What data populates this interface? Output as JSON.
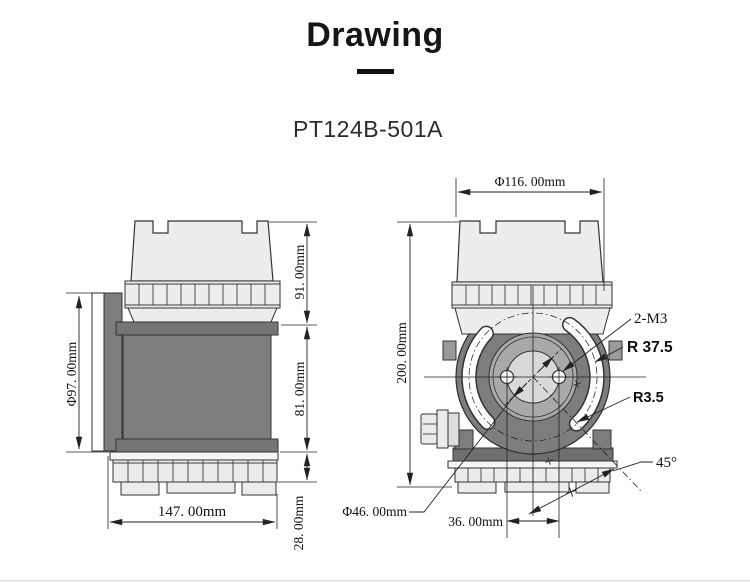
{
  "header": {
    "title": "Drawing",
    "model": "PT124B-501A"
  },
  "left_view": {
    "description": "side view of transmitter",
    "phi97": "Φ97. 00mm",
    "h91": "91. 00mm",
    "h81": "81. 00mm",
    "h28": "28. 00mm",
    "w147": "147. 00mm"
  },
  "right_view": {
    "description": "front view of transmitter",
    "phi116": "Φ116. 00mm",
    "h200": "200. 00mm",
    "m3": "2-M3",
    "r375": "R 37.5",
    "r35": "R3.5",
    "deg45": "45°",
    "phi46": "Φ46. 00mm",
    "w36": "36. 00mm"
  },
  "colors": {
    "body_gray": "#7d7d7d",
    "cap_gray": "#ededed",
    "disk_gray": "#a9a9a9",
    "center_gray": "#d9d9d9",
    "line": "#222222"
  }
}
